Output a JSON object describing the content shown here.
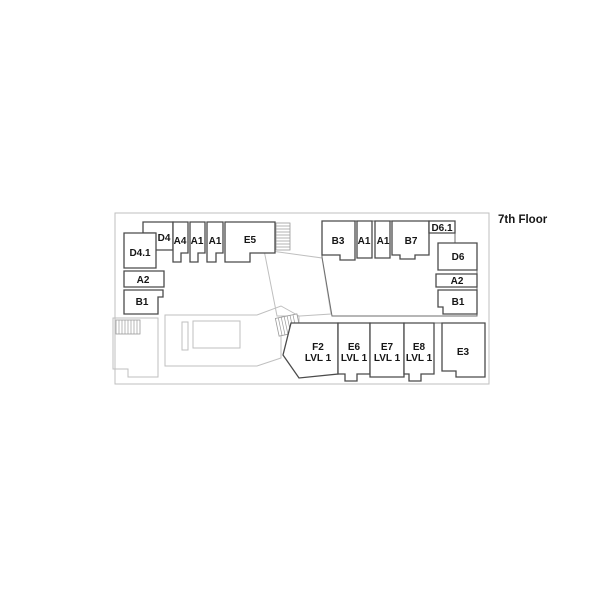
{
  "title": "7th Floor",
  "colors": {
    "background": "#ffffff",
    "unit_wall": "#4b4b4b",
    "corridor_line": "#bfbfbf",
    "label_text": "#161616"
  },
  "rooms": {
    "d4_1": {
      "label": "D4.1"
    },
    "d4": {
      "label": "D4"
    },
    "a4": {
      "label": "A4"
    },
    "a1_left_1": {
      "label": "A1"
    },
    "a1_left_2": {
      "label": "A1"
    },
    "e5": {
      "label": "E5"
    },
    "a2_left": {
      "label": "A2"
    },
    "b1_left": {
      "label": "B1"
    },
    "b3": {
      "label": "B3"
    },
    "a1_right_1": {
      "label": "A1"
    },
    "a1_right_2": {
      "label": "A1"
    },
    "b7": {
      "label": "B7"
    },
    "d6_1": {
      "label": "D6.1"
    },
    "d6": {
      "label": "D6"
    },
    "a2_right": {
      "label": "A2"
    },
    "b1_right": {
      "label": "B1"
    },
    "f2": {
      "label": "F2",
      "sublabel": "LVL 1"
    },
    "e6": {
      "label": "E6",
      "sublabel": "LVL 1"
    },
    "e7": {
      "label": "E7",
      "sublabel": "LVL 1"
    },
    "e8": {
      "label": "E8",
      "sublabel": "LVL 1"
    },
    "e3": {
      "label": "E3"
    }
  }
}
